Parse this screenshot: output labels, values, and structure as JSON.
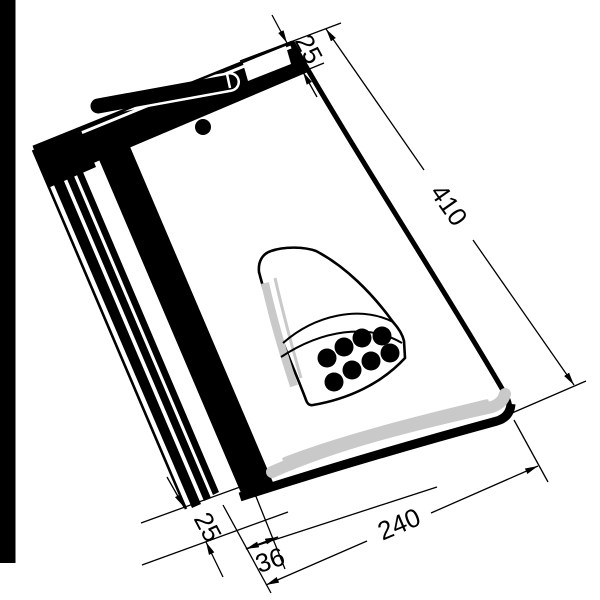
{
  "drawing": {
    "subject": "roof ventilation tile - isometric technical line drawing",
    "colors": {
      "line": "#000000",
      "shading": "#c9c9c9",
      "background": "#ffffff"
    },
    "vent": {
      "hole_count": 8
    }
  },
  "dimensions": {
    "head_lap": {
      "value": "25"
    },
    "length": {
      "value": "410"
    },
    "width": {
      "value": "240"
    },
    "side_inset": {
      "value": "36"
    },
    "side_lap": {
      "value": "25"
    }
  }
}
